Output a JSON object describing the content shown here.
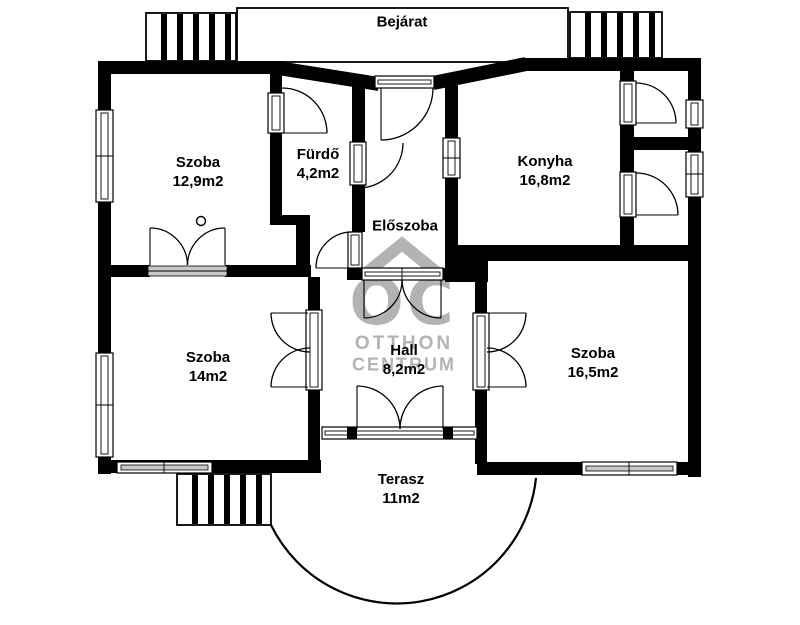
{
  "watermark": {
    "logo_text": "OC",
    "line1": "OTTHON",
    "line2": "CENTRUM"
  },
  "labels": {
    "bejarat": {
      "name": "Bejárat"
    },
    "szoba1": {
      "name": "Szoba",
      "area": "12,9m2"
    },
    "furdo": {
      "name": "Fürdő",
      "area": "4,2m2"
    },
    "konyha": {
      "name": "Konyha",
      "area": "16,8m2"
    },
    "eloszoba": {
      "name": "Előszoba"
    },
    "szoba2": {
      "name": "Szoba",
      "area": "14m2"
    },
    "hall": {
      "name": "Hall",
      "area": "8,2m2"
    },
    "szoba3": {
      "name": "Szoba",
      "area": "16,5m2"
    },
    "terasz": {
      "name": "Terasz",
      "area": "11m2"
    }
  },
  "colors": {
    "wall": "#000000",
    "background": "#ffffff",
    "watermark": "#b3b3b3",
    "sill": "#c8c8c8"
  }
}
